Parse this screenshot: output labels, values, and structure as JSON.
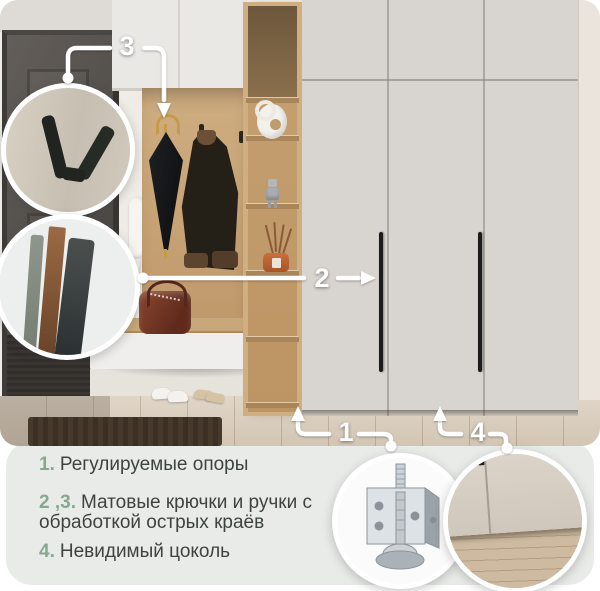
{
  "callouts": {
    "one": "1",
    "two": "2",
    "three": "3",
    "four": "4"
  },
  "legend": {
    "items": [
      {
        "number": "1.",
        "text": "Регулируемые опоры"
      },
      {
        "number": "2 ,3.",
        "text": "Матовые крючки и ручки с обработкой острых краёв"
      },
      {
        "number": "4.",
        "text": "Невидимый цоколь"
      }
    ]
  },
  "colors": {
    "legend_number_green": "#85a98e",
    "legend_text": "#3d4440",
    "legend_panel_bg": "#e9ebe9",
    "callout_white": "#ffffff",
    "wardrobe_door": "#d8d4cf",
    "oak_wood": "#cfae82"
  },
  "insets": {
    "hook_circle": "matte-hook-closeup",
    "handle_circle": "matte-handle-edge-closeup",
    "leveler_circle": "adjustable-foot-closeup",
    "plinth_circle": "hidden-plinth-closeup"
  }
}
